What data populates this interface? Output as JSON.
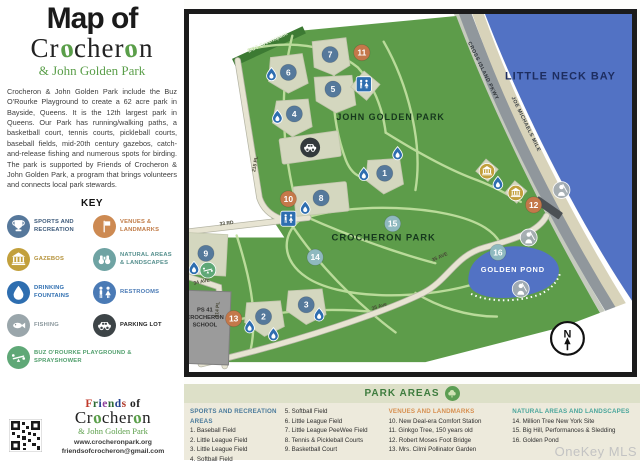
{
  "sidebar": {
    "title_line1": "Map of",
    "title_line2": "Crocheron",
    "title_line3": "& John Golden Park",
    "description": "Crocheron & John Golden Park include the Buz O'Rourke Playground to create a 62 acre park in Bayside, Queens. It is the 12th largest park in Queens. Our Park has running/walking paths, a basketball court, tennis courts, pickleball courts, baseball fields, mid-20th century gazebos, catch-and-release fishing and numerous spots for birding. The park is supported by Friends of Crocheron & John Golden Park, a program that brings volunteers and connects local park stewards.",
    "key": {
      "heading": "KEY",
      "items": [
        {
          "label": "SPORTS AND RECREATION",
          "icon": "trophy-icon",
          "color": "#56789b",
          "text_color": "#3d5a7a"
        },
        {
          "label": "VENUES & LANDMARKS",
          "icon": "flag-icon",
          "color": "#cd8a52",
          "text_color": "#c07a45"
        },
        {
          "label": "GAZEBOS",
          "icon": "gazebo-icon",
          "color": "#c2a03c",
          "text_color": "#b5923a"
        },
        {
          "label": "NATURAL AREAS & LANDSCAPES",
          "icon": "binoculars-icon",
          "color": "#6fa3a3",
          "text_color": "#558f8d"
        },
        {
          "label": "DRINKING FOUNTAINS",
          "icon": "water-drop-icon",
          "color": "#2e6eb0",
          "text_color": "#2e6eb0"
        },
        {
          "label": "RESTROOMS",
          "icon": "restroom-icon",
          "color": "#4a7ab5",
          "text_color": "#4a7ab5"
        },
        {
          "label": "FISHING",
          "icon": "fish-icon",
          "color": "#9aa6ab",
          "text_color": "#8a979c"
        },
        {
          "label": "PARKING LOT",
          "icon": "car-icon",
          "color": "#3d4447",
          "text_color": "#222222"
        },
        {
          "label": "BUZ O'ROURKE PLAYGROUND & SPRAYSHOWER",
          "icon": "playground-icon",
          "color": "#5fa877",
          "text_color": "#4f9e6b"
        }
      ]
    },
    "footer": {
      "logo_line1": "Friends of",
      "logo_line2": "Crocheron",
      "logo_line3": "& John Golden Park",
      "website": "www.crocheronpark.org",
      "email": "friendsofcrocheron@gmail.com"
    }
  },
  "map": {
    "compass": "N",
    "marker_colors": {
      "sport": "#55799b",
      "venue": "#c4784a",
      "natural": "#8fb9bf"
    },
    "labels": [
      {
        "text": "JOHN GOLDEN PARK",
        "x": 203,
        "y": 107,
        "size": 9,
        "weight": 800,
        "color": "#16381d",
        "spacing": 1
      },
      {
        "text": "CROCHERON PARK",
        "x": 196,
        "y": 229,
        "size": 9.5,
        "weight": 800,
        "color": "#16381d",
        "spacing": 1
      },
      {
        "text": "LITTLE NECK BAY",
        "x": 374,
        "y": 66,
        "size": 11,
        "weight": 800,
        "color": "#1d2d60",
        "spacing": 1
      },
      {
        "text": "GOLDEN POND",
        "x": 326,
        "y": 261,
        "size": 7.5,
        "weight": 800,
        "color": "#ffffff",
        "spacing": 0.8
      },
      {
        "text": "CROSS ISLAND PKWY",
        "x": 295,
        "y": 58,
        "size": 5.2,
        "weight": 600,
        "color": "#2e3338",
        "rot": 64,
        "spacing": 0.5
      },
      {
        "text": "JOE MICHAELS MILE",
        "x": 338,
        "y": 112,
        "size": 5.2,
        "weight": 600,
        "color": "#3a4045",
        "rot": 64,
        "spacing": 0.5
      },
      {
        "text": "DOT Greenspace",
        "x": 80,
        "y": 30,
        "size": 5.4,
        "weight": 600,
        "color": "#e8f2dc",
        "rot": -25
      },
      {
        "text": "33 RD",
        "x": 38,
        "y": 213,
        "size": 5,
        "weight": 600,
        "color": "#474736",
        "rot": -7
      },
      {
        "text": "34 AVE",
        "x": 13,
        "y": 272,
        "size": 5,
        "weight": 600,
        "color": "#474736",
        "rot": -12
      },
      {
        "text": "214 PL",
        "x": 30,
        "y": 299,
        "size": 5,
        "weight": 600,
        "color": "#474736",
        "rot": -84
      },
      {
        "text": "215 PL",
        "x": 68,
        "y": 152,
        "size": 5,
        "weight": 600,
        "color": "#474736",
        "rot": -80
      },
      {
        "text": "35 Ave",
        "x": 192,
        "y": 297,
        "size": 5,
        "weight": 600,
        "color": "#474736",
        "rot": -18
      },
      {
        "text": "35 AVE",
        "x": 253,
        "y": 247,
        "size": 5,
        "weight": 600,
        "color": "#474736",
        "rot": -24
      },
      {
        "lines": [
          "PS 41",
          "CROCHERON",
          "SCHOOL"
        ],
        "x": 16,
        "y": 301,
        "lh": 7.5,
        "size": 5.8,
        "weight": 700,
        "color": "#2f2f2f"
      }
    ],
    "markers": [
      {
        "n": 1,
        "type": "sport",
        "x": 197,
        "y": 161
      },
      {
        "n": 2,
        "type": "sport",
        "x": 75,
        "y": 306
      },
      {
        "n": 3,
        "type": "sport",
        "x": 118,
        "y": 294
      },
      {
        "n": 4,
        "type": "sport",
        "x": 106,
        "y": 101
      },
      {
        "n": 5,
        "type": "sport",
        "x": 145,
        "y": 76
      },
      {
        "n": 6,
        "type": "sport",
        "x": 100,
        "y": 59
      },
      {
        "n": 7,
        "type": "sport",
        "x": 142,
        "y": 41
      },
      {
        "n": 8,
        "type": "sport",
        "x": 133,
        "y": 186
      },
      {
        "n": 9,
        "type": "sport",
        "x": 17,
        "y": 242
      },
      {
        "n": 10,
        "type": "venue",
        "x": 100,
        "y": 187
      },
      {
        "n": 11,
        "type": "venue",
        "x": 174,
        "y": 39
      },
      {
        "n": 12,
        "type": "venue",
        "x": 347,
        "y": 193
      },
      {
        "n": 13,
        "type": "venue",
        "x": 45,
        "y": 308
      },
      {
        "n": 14,
        "type": "natural",
        "x": 127,
        "y": 246
      },
      {
        "n": 15,
        "type": "natural",
        "x": 205,
        "y": 212
      },
      {
        "n": 16,
        "type": "natural",
        "x": 311,
        "y": 241
      }
    ],
    "icons": [
      {
        "type": "fountain-icon",
        "x": 83,
        "y": 61
      },
      {
        "type": "fountain-icon",
        "x": 89,
        "y": 104
      },
      {
        "type": "fountain-icon",
        "x": 176,
        "y": 162
      },
      {
        "type": "fountain-icon",
        "x": 210,
        "y": 141
      },
      {
        "type": "fountain-icon",
        "x": 117,
        "y": 196
      },
      {
        "type": "fountain-icon",
        "x": 5,
        "y": 257
      },
      {
        "type": "fountain-icon",
        "x": 61,
        "y": 316
      },
      {
        "type": "fountain-icon",
        "x": 85,
        "y": 324
      },
      {
        "type": "fountain-icon",
        "x": 131,
        "y": 304
      },
      {
        "type": "fountain-icon",
        "x": 311,
        "y": 171
      },
      {
        "type": "restroom-icon",
        "x": 176,
        "y": 71,
        "s": 0.8
      },
      {
        "type": "restroom-icon",
        "x": 100,
        "y": 207,
        "s": 0.8
      },
      {
        "type": "gazebo-icon",
        "x": 300,
        "y": 159,
        "s": 0.78
      },
      {
        "type": "gazebo-icon",
        "x": 329,
        "y": 181,
        "s": 0.78
      },
      {
        "type": "fisher-icon",
        "x": 375,
        "y": 178,
        "s": 0.85
      },
      {
        "type": "fisher-icon",
        "x": 342,
        "y": 226,
        "s": 0.85
      },
      {
        "type": "fisher-icon",
        "x": 334,
        "y": 278,
        "s": 0.85
      },
      {
        "type": "parking-icon",
        "x": 122,
        "y": 135,
        "s": 0.95
      },
      {
        "type": "playground-icon",
        "x": 19,
        "y": 259,
        "s": 0.8
      }
    ]
  },
  "legend": {
    "heading": "PARK AREAS",
    "columns": [
      {
        "header": "SPORTS AND RECREATION AREAS",
        "color": "#4a7a9b",
        "items": [
          "1. Baseball Field",
          "2. Little League Field",
          "3. Little League Field",
          "4. Softball Field"
        ]
      },
      {
        "header": "",
        "color": "#4a7a9b",
        "items": [
          "5. Softball Field",
          "6. Little League Field",
          "7. Little League PeeWee Field",
          "8. Tennis & Pickleball Courts",
          "9. Basketball Court"
        ]
      },
      {
        "header": "VENUES AND LANDMARKS",
        "color": "#d78f4f",
        "items": [
          "10. New Deal-era Comfort Station",
          "11. Ginkgo Tree, 150 years old",
          "12. Robert Moses Foot Bridge",
          "13. Mrs. Cilmi Pollinator Garden"
        ]
      },
      {
        "header": "NATURAL AREAS AND LANDSCAPES",
        "color": "#49a59b",
        "items": [
          "14. Million Tree New York Site",
          "15. Big Hill, Performances & Sledding",
          "16. Golden Pond"
        ]
      }
    ]
  },
  "watermark": "OneKey MLS"
}
